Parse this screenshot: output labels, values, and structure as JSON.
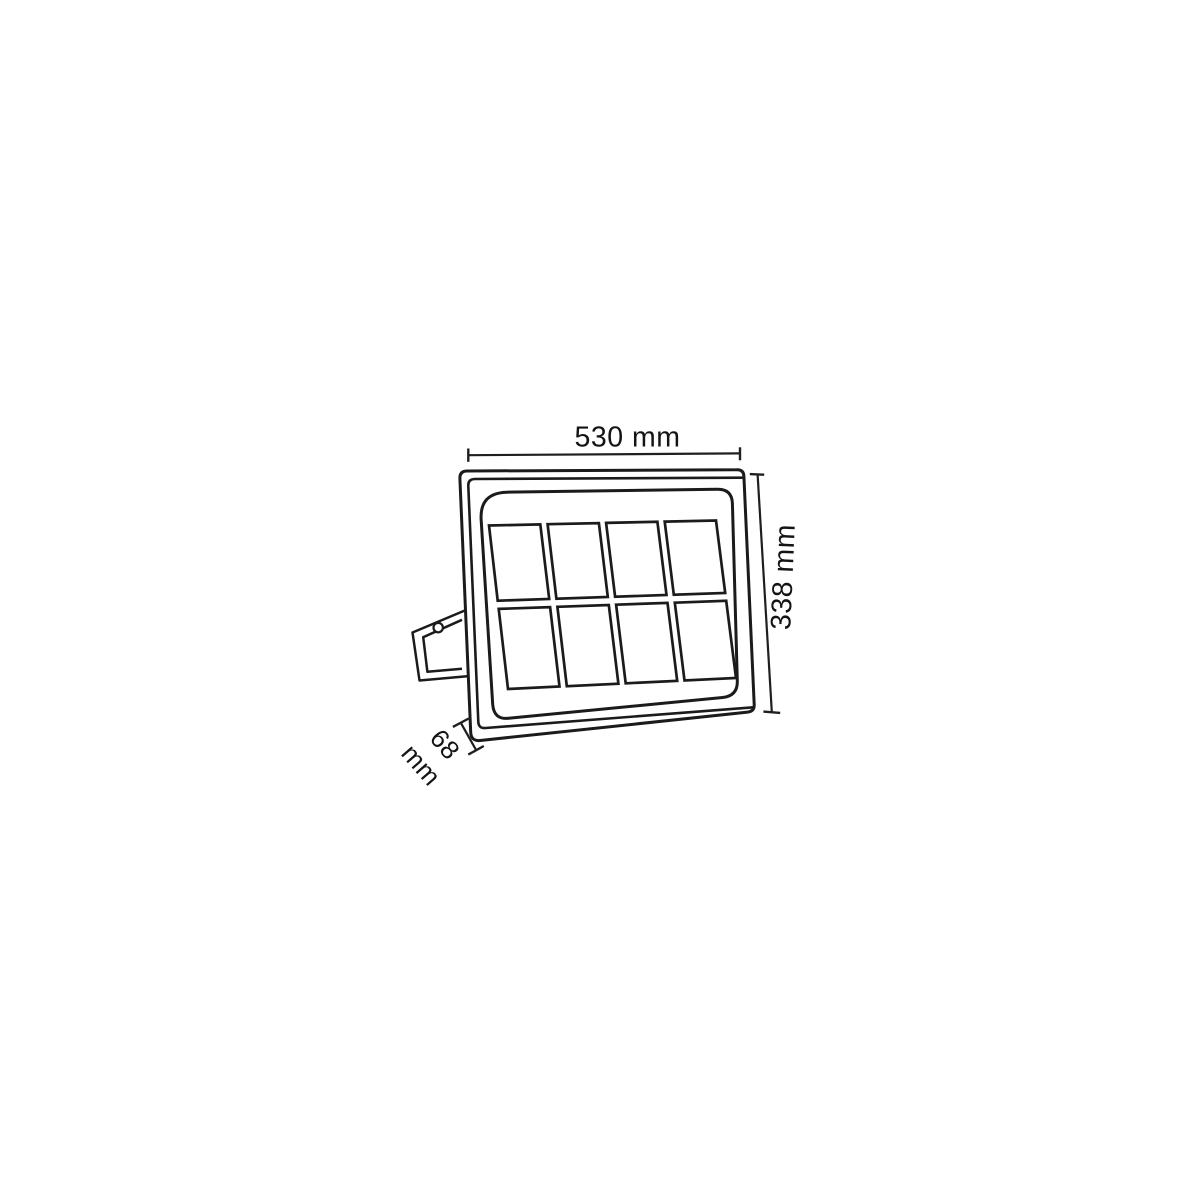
{
  "diagram": {
    "type": "technical-dimension-drawing",
    "subject": "LED floodlight front view with mounting bracket",
    "dimensions": {
      "width": "530 mm",
      "height": "338 mm",
      "depth_value": "68",
      "depth_unit": "mm"
    },
    "panel_grid": {
      "rows": 2,
      "columns": 4,
      "total_cells": 8
    },
    "colors": {
      "line": "#1b1b1b",
      "background": "#ffffff"
    }
  }
}
